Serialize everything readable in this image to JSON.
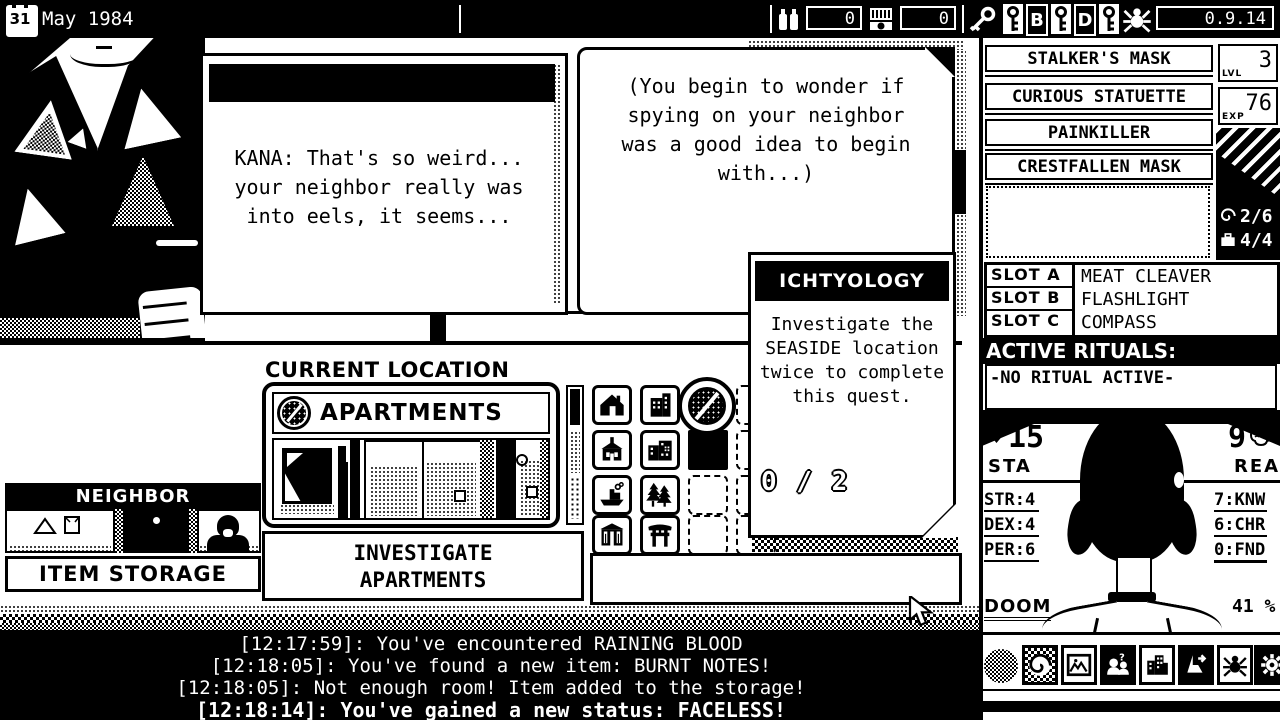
{
  "topbar": {
    "day": "31",
    "date": "May 1984",
    "ammo_count": "0",
    "matches_count": "0",
    "rune_b": "B",
    "rune_d": "D",
    "version": "0.9.14"
  },
  "dialogue": {
    "line1": "KANA: That's so weird...",
    "line2": "your neighbor really was",
    "line3": "into eels, it seems..."
  },
  "narration": {
    "line1": "(You begin to wonder if",
    "line2": "spying on your neighbor",
    "line3": "was a good idea to begin",
    "line4": "with...)"
  },
  "quest": {
    "title": "ICHTYOLOGY",
    "line1": "Investigate the",
    "line2": "SEASIDE location",
    "line3": "twice to complete",
    "line4": "this quest.",
    "progress": "0 / 2"
  },
  "location": {
    "header": "CURRENT LOCATION",
    "name": "APARTMENTS",
    "investigate_line1": "INVESTIGATE",
    "investigate_line2": "APARTMENTS"
  },
  "neighbor": {
    "title": "NEIGHBOR",
    "storage_label": "ITEM STORAGE"
  },
  "inventory": {
    "items": [
      "STALKER'S MASK",
      "CURIOUS STATUETTE",
      "PAINKILLER",
      "CRESTFALLEN MASK"
    ],
    "lvl_label": "LVL",
    "lvl_value": "3",
    "exp_label": "EXP",
    "exp_value": "76",
    "spiral_count": "2/6",
    "bag_count": "4/4",
    "slots": [
      {
        "label": "SLOT A",
        "item": "MEAT CLEAVER"
      },
      {
        "label": "SLOT B",
        "item": "FLASHLIGHT"
      },
      {
        "label": "SLOT C",
        "item": "COMPASS"
      }
    ]
  },
  "rituals": {
    "header": "ACTIVE RITUALS:",
    "none_text": "-NO RITUAL ACTIVE-"
  },
  "stats": {
    "sta_value": "15",
    "sta_label": "STA",
    "rea_value": "9",
    "rea_label": "REA",
    "str": "STR:4",
    "dex": "DEX:4",
    "per": "PER:6",
    "knw": "7:KNW",
    "chr": "6:CHR",
    "fnd": "0:FND",
    "doom_label": "DOOM",
    "doom_value": "41 %"
  },
  "log": {
    "lines": [
      "[12:17:59]: You've encountered RAINING BLOOD",
      "[12:18:05]: You've found a new item: BURNT NOTES!",
      "[12:18:05]: Not enough room! Item added to the storage!",
      "[12:18:14]: You've gained a new status: FACELESS!"
    ]
  }
}
